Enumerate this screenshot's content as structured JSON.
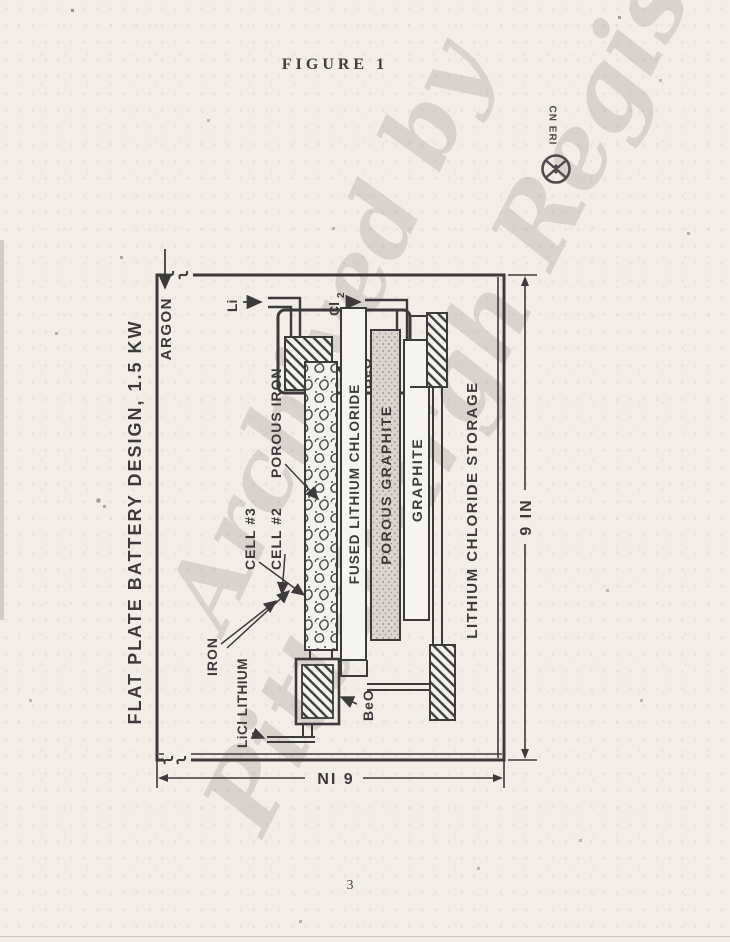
{
  "page": {
    "figure_caption": "FIGURE 1",
    "page_number": "3",
    "paper_color": "#f1eee8",
    "ink_color": "#3b3b3b"
  },
  "stamp": {
    "text": "CN ERI",
    "icon": "circled-x"
  },
  "watermark": {
    "line1": "Archived by",
    "line2": "Pittsburgh Registry"
  },
  "diagram": {
    "title": "FLAT PLATE BATTERY DESIGN, 1.5 KW",
    "gas_inlet": "ARGON",
    "feed_li": "Li",
    "feed_cl_main": "Cl",
    "feed_cl_sub": "2",
    "labels": {
      "porous_iron": "POROUS IRON",
      "beo_upper": "BeO",
      "beo_lower": "BeO",
      "cell3": "CELL #3",
      "cell2": "CELL #2",
      "iron": "IRON",
      "licl_lithium": "LiCl LITHIUM"
    },
    "layers": {
      "fused": "FUSED LITHIUM CHLORIDE",
      "porous_graphite": "POROUS GRAPHITE",
      "graphite": "GRAPHITE",
      "storage": "LITHIUM CHLORIDE STORAGE"
    },
    "dimensions": {
      "width": "9 IN",
      "height": "6 IN"
    }
  }
}
